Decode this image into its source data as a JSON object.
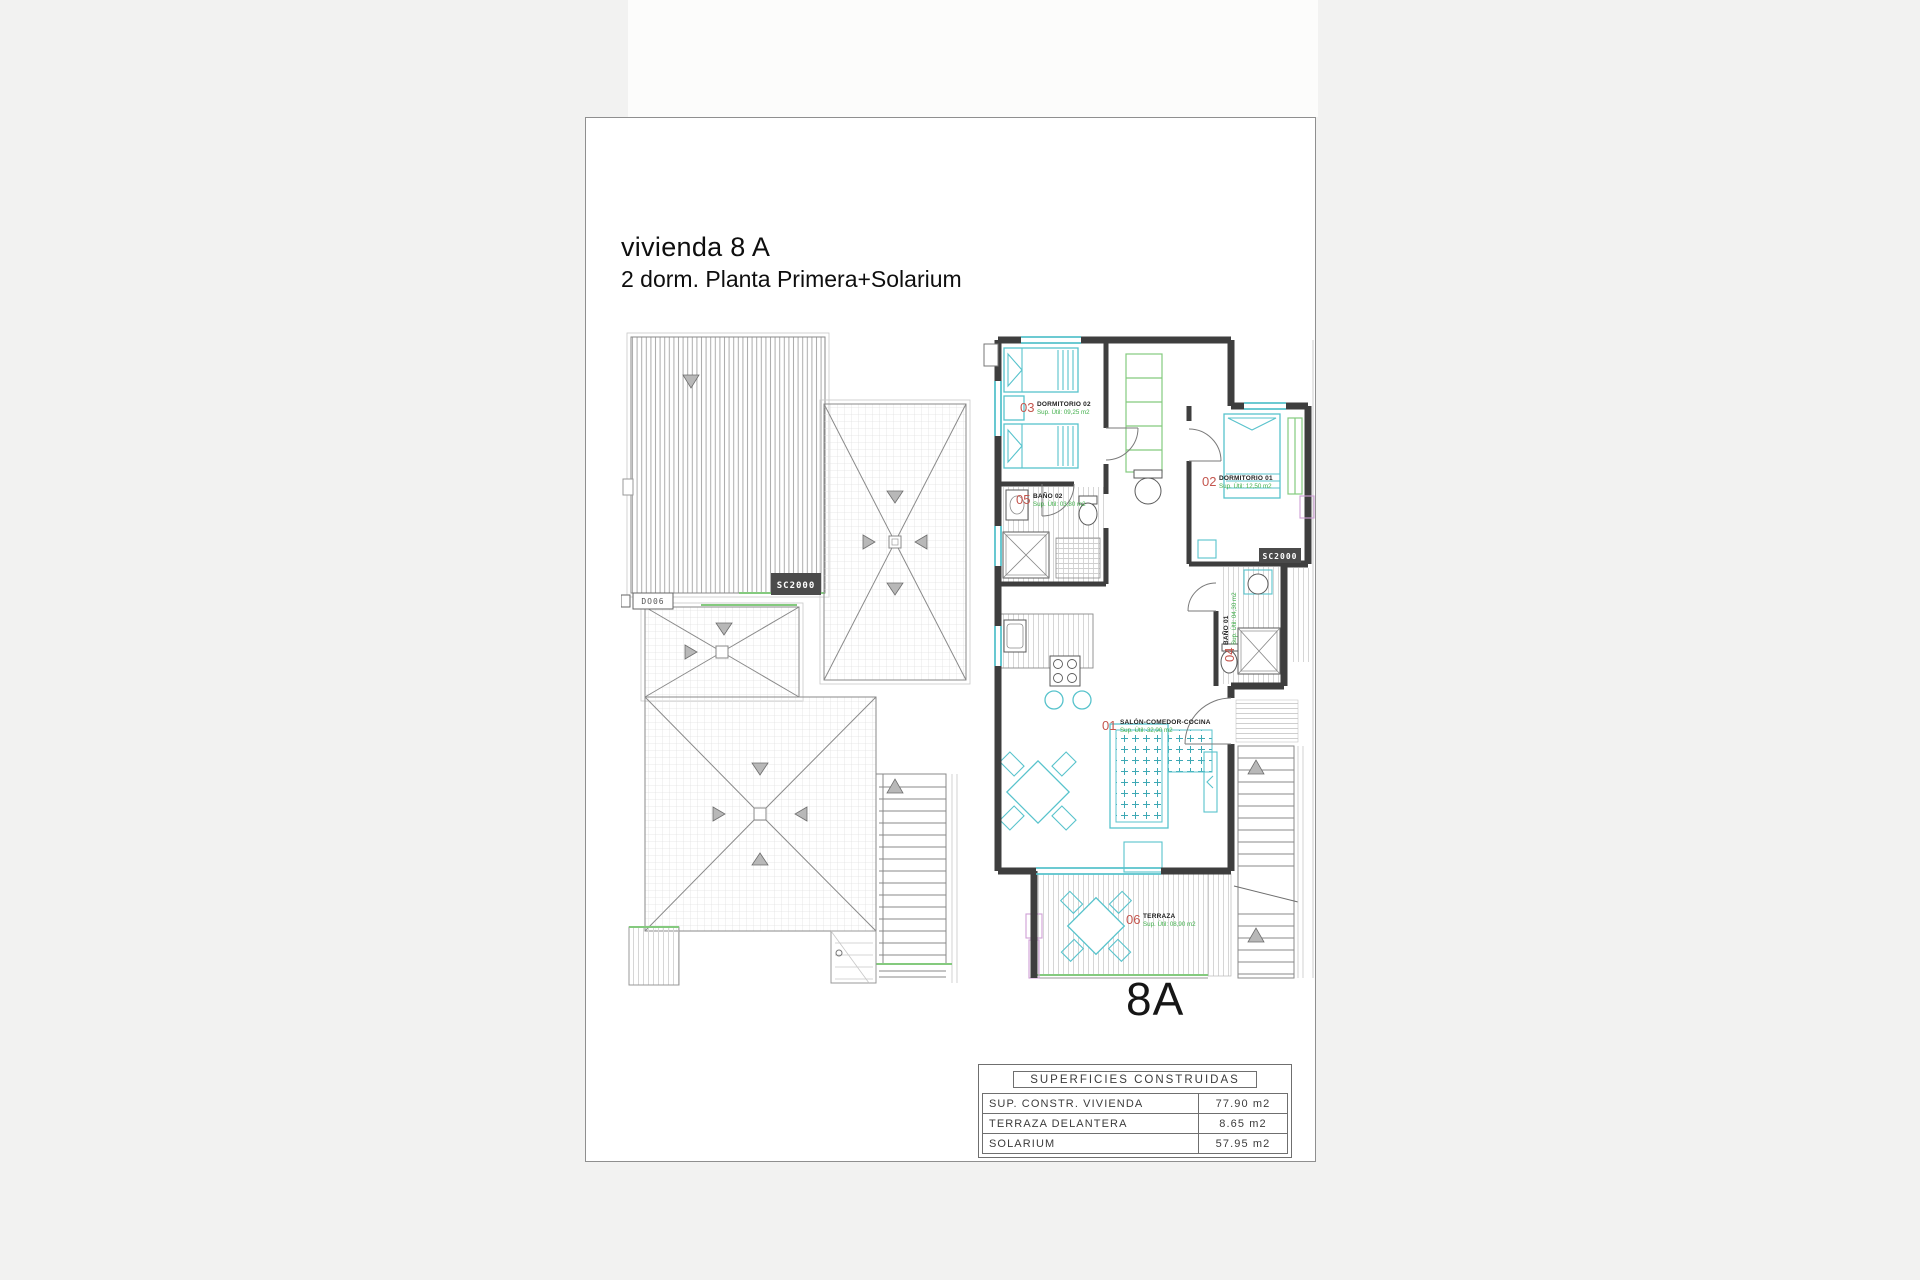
{
  "page": {
    "title_line1": "vivienda 8 A",
    "title_line2": "2 dorm.  Planta Primera+Solarium",
    "unit_label": "8A"
  },
  "floor_plan": {
    "rooms": [
      {
        "number": "01",
        "name": "SALÓN-COMEDOR-COCINA",
        "area": "Sup. Útil: 32,00 m2"
      },
      {
        "number": "02",
        "name": "DORMITORIO 01",
        "area": "Sup. Útil: 12,50 m2"
      },
      {
        "number": "03",
        "name": "DORMITORIO 02",
        "area": "Sup. Útil: 09,25 m2"
      },
      {
        "number": "04",
        "name": "BAÑO 01",
        "area": "Sup. Útil: 04,30 m2"
      },
      {
        "number": "05",
        "name": "BAÑO 02",
        "area": "Sup. Útil: 03,80 m2"
      },
      {
        "number": "06",
        "name": "TERRAZA",
        "area": "Sup. Útil: 08,90 m2"
      }
    ],
    "markers": {
      "carpentry_code": "SC2000",
      "roof_access_code": "DO06"
    }
  },
  "areas_table": {
    "header": "SUPERFICIES  CONSTRUIDAS",
    "rows": [
      {
        "label": "SUP.  CONSTR.  VIVIENDA",
        "value": "77.90  m2"
      },
      {
        "label": "TERRAZA  DELANTERA",
        "value": "8.65  m2"
      },
      {
        "label": "SOLARIUM",
        "value": "57.95  m2"
      }
    ]
  },
  "colors": {
    "wall": "#3e3e3e",
    "furniture_cyan": "#58c3cc",
    "window_green": "#84ca7e",
    "room_number_red": "#c4564e",
    "area_text_green": "#3fae49",
    "roof_line_gray": "#8a8a8a"
  }
}
